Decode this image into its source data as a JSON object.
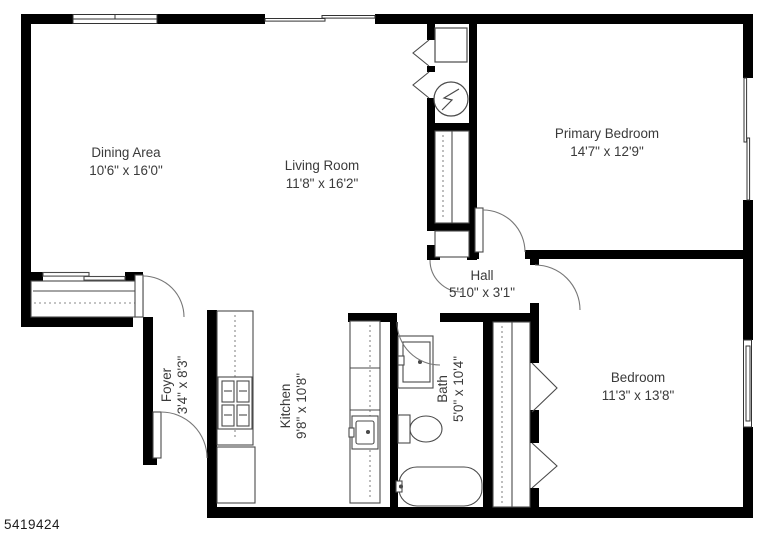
{
  "page": {
    "background": "#ffffff",
    "listing_id": "5419424"
  },
  "floorplan": {
    "wall_color": "#000000",
    "label_color": "#3a3a3a",
    "rooms": {
      "dining": {
        "name": "Dining Area",
        "dims": "10'6\" x 16'0\""
      },
      "living": {
        "name": "Living Room",
        "dims": "11'8\" x 16'2\""
      },
      "primary": {
        "name": "Primary Bedroom",
        "dims": "14'7\" x 12'9\""
      },
      "hall": {
        "name": "Hall",
        "dims": "5'10\" x 3'1\""
      },
      "foyer": {
        "name": "Foyer",
        "dims": "3'4\" x 8'3\""
      },
      "kitchen": {
        "name": "Kitchen",
        "dims": "9'8\" x 10'8\""
      },
      "bath": {
        "name": "Bath",
        "dims": "5'0\" x 10'4\""
      },
      "bedroom": {
        "name": "Bedroom",
        "dims": "11'3\" x 13'8\""
      }
    },
    "fixtures": [
      "washer",
      "dryer",
      "hall-closet-rod",
      "entry-closet-sliding-doors",
      "linen-closet",
      "stove",
      "kitchen-sink",
      "lower-cabinet",
      "bathroom-vanity",
      "toilet",
      "bathtub",
      "bedroom-closet-rod",
      "bifold-doors",
      "swing-doors",
      "windows"
    ]
  }
}
